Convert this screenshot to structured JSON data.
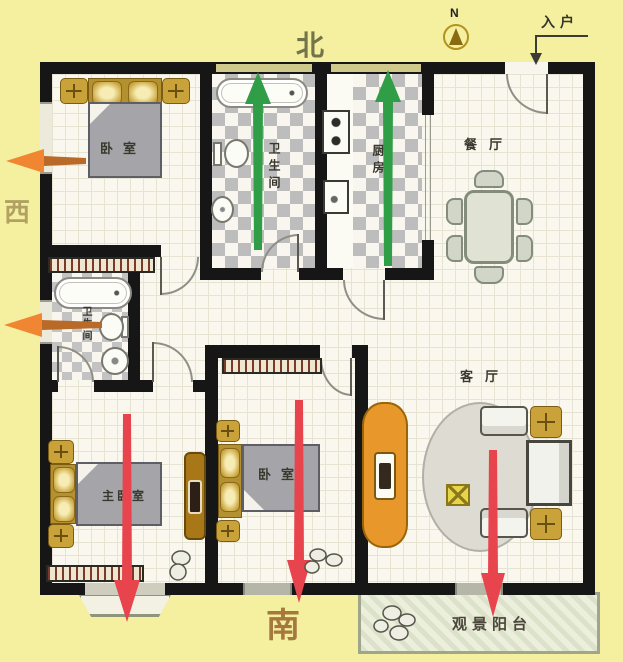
{
  "compass": {
    "n_letter": "N",
    "north": "北",
    "south": "南",
    "west": "西"
  },
  "entry": {
    "label": "入户"
  },
  "rooms": {
    "bedroom_north": "卧室",
    "bathroom_north": "卫生间",
    "kitchen": "厨房",
    "dining": "餐厅",
    "living": "客厅",
    "master_bedroom": "主卧室",
    "bedroom_south": "卧室",
    "bathroom_west": "卫生间",
    "balcony": "观景阳台"
  },
  "colors": {
    "background": "#f4f0a0",
    "wall": "#161616",
    "arrow_green": "#2f9e47",
    "arrow_red": "#e8444e",
    "arrow_orange": "#f08632",
    "furniture_gold": "#c9a23a",
    "cabinet_orange": "#e8982a",
    "cabinet_brown": "#a87818",
    "floor": "#faf8ee",
    "balcony_floor": "#ebefdb"
  }
}
